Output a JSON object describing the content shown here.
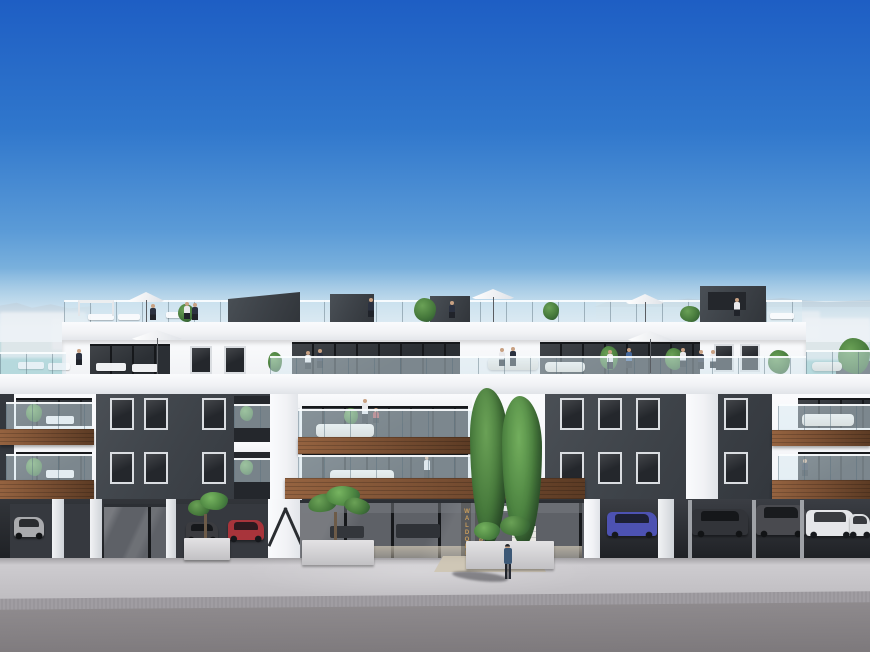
{
  "scene": {
    "type": "3d-architectural-render-of-apartment-building",
    "sign": {
      "line1": "WALDORF",
      "line2": "ASTORIA"
    },
    "umbrella_count": 5,
    "colors": {
      "sky_top": "#1e5ec4",
      "sky_mid": "#3077cc",
      "sky_low": "#5b9bd7",
      "sky_horizon": "#93c2e1",
      "sea": "#a5c8da",
      "mountain": "#8fa9bd",
      "distant": "#e9ebef",
      "white": "#f1f2f5",
      "white_bright": "#fafbfd",
      "white_shade": "#e0e3e8",
      "parapet_edge": "#c3c8d0",
      "dark_panel": "#3e4349",
      "dark_panel2": "#33373d",
      "opening": "#24272c",
      "glaze": "#2b2f34",
      "mullion": "#16181b",
      "win_frame": "#dadde1",
      "wood": "#7c5134",
      "wood_light": "#956340",
      "wood_dark": "#5c3b24",
      "plant": "#477a3c",
      "plant_light": "#6aa156",
      "plant_dark": "#2d5730",
      "plaza": "#bdbbbf",
      "plaza_light": "#d0ced2",
      "paver": "#99969b",
      "road": "#8e8a8d",
      "road_dark": "#7c787b",
      "curb": "#d9d9db",
      "garage": "#36393f",
      "garage_dark": "#1d1f23",
      "gold": "#c79c5c",
      "skin": "#c8a183",
      "stair": "#eae8e4",
      "tan_floor": "#cec5b3",
      "p_white": "#e9e9ec",
      "p_dark": "#2b3140",
      "p_blue": "#46689c",
      "p_red": "#a84a4e",
      "pants": "#20232a"
    },
    "cars": [
      {
        "name": "white-hatchback-far-left",
        "color": "#d9dade"
      },
      {
        "name": "grey-car-left-garage",
        "color": "#4b4d53"
      },
      {
        "name": "red-car-left-garage",
        "color": "#a8343b"
      },
      {
        "name": "blue-suv-right-garage",
        "color": "#4d52b2"
      },
      {
        "name": "grey-wagon-right-garage",
        "color": "#3f434a"
      },
      {
        "name": "grey-suv-right-garage",
        "color": "#5d5f66"
      },
      {
        "name": "white-suv-right-garage",
        "color": "#e5e6e9"
      },
      {
        "name": "white-car-far-right",
        "color": "#dcdee1"
      }
    ]
  }
}
